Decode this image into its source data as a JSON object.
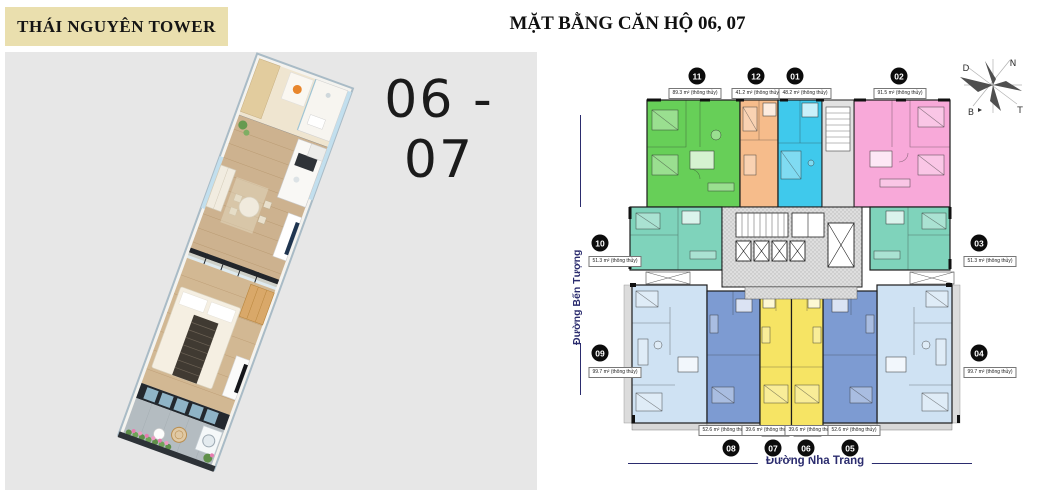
{
  "header": {
    "brand": "THÁI NGUYÊN TOWER",
    "title": "MẶT BẰNG CĂN HỘ 06, 07"
  },
  "render_panel": {
    "unit_label": "06 - 07"
  },
  "floor_plan": {
    "street_left": "Đường Bến Tượng",
    "street_bottom": "Đường Nha Trang",
    "compass": {
      "nw": "D",
      "ne": "N",
      "sw": "B",
      "se": "T"
    },
    "units": [
      {
        "id": "11",
        "area": "89.3 m² (thông thủy)",
        "color": "#67cf58"
      },
      {
        "id": "12",
        "area": "41.2 m² (thông thủy)",
        "color": "#f6bc8b"
      },
      {
        "id": "01",
        "area": "48.2 m² (thông thủy)",
        "color": "#3fc9ec"
      },
      {
        "id": "02",
        "area": "91.5 m² (thông thủy)",
        "color": "#f8a9d9"
      },
      {
        "id": "10",
        "area": "51.3 m² (thông thủy)",
        "color": "#7fd3bb"
      },
      {
        "id": "03",
        "area": "51.3 m² (thông thủy)",
        "color": "#7fd3bb"
      },
      {
        "id": "09",
        "area": "99.7 m² (thông thủy)",
        "color": "#cfe2f3"
      },
      {
        "id": "04",
        "area": "99.7 m² (thông thủy)",
        "color": "#cfe2f3"
      },
      {
        "id": "08",
        "area": "52.6 m² (thông thủy)",
        "color": "#7d9bd2"
      },
      {
        "id": "07",
        "area": "39.6 m² (thông thủy)",
        "color": "#f6e464"
      },
      {
        "id": "06",
        "area": "39.6 m² (thông thủy)",
        "color": "#f6e464"
      },
      {
        "id": "05",
        "area": "52.6 m² (thông thủy)",
        "color": "#7d9bd2"
      }
    ]
  }
}
